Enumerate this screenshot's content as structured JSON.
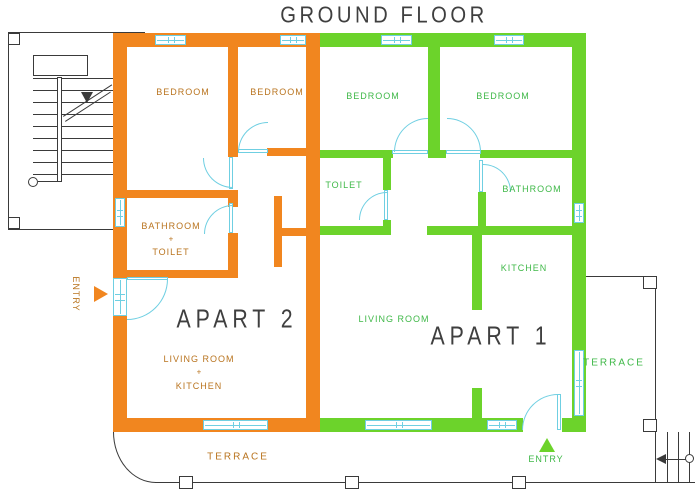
{
  "title": "GROUND FLOOR",
  "apart2": {
    "name": "APART 2",
    "bedroom1": "BEDROOM",
    "bedroom2": "BEDROOM",
    "bathroom_l1": "BATHROOM",
    "bathroom_l2": "+",
    "bathroom_l3": "TOILET",
    "living_l1": "LIVING ROOM",
    "living_l2": "+",
    "living_l3": "KITCHEN",
    "entry": "ENTRY"
  },
  "apart1": {
    "name": "APART 1",
    "bedroom1": "BEDROOM",
    "bedroom2": "BEDROOM",
    "toilet": "TOILET",
    "bathroom": "BATHROOM",
    "kitchen": "KITCHEN",
    "living": "LIVING ROOM",
    "entry": "ENTRY"
  },
  "terrace_bottom": "TERRACE",
  "terrace_right": "TERRACE",
  "colors": {
    "wall_orange": "#F1861F",
    "wall_green": "#6CD32B",
    "opening_cyan": "#6FCFE2",
    "text_orange": "#B9741F",
    "text_green": "#3FB848",
    "text_dark": "#3F3F3F",
    "line_dark": "#3A3A3A"
  }
}
